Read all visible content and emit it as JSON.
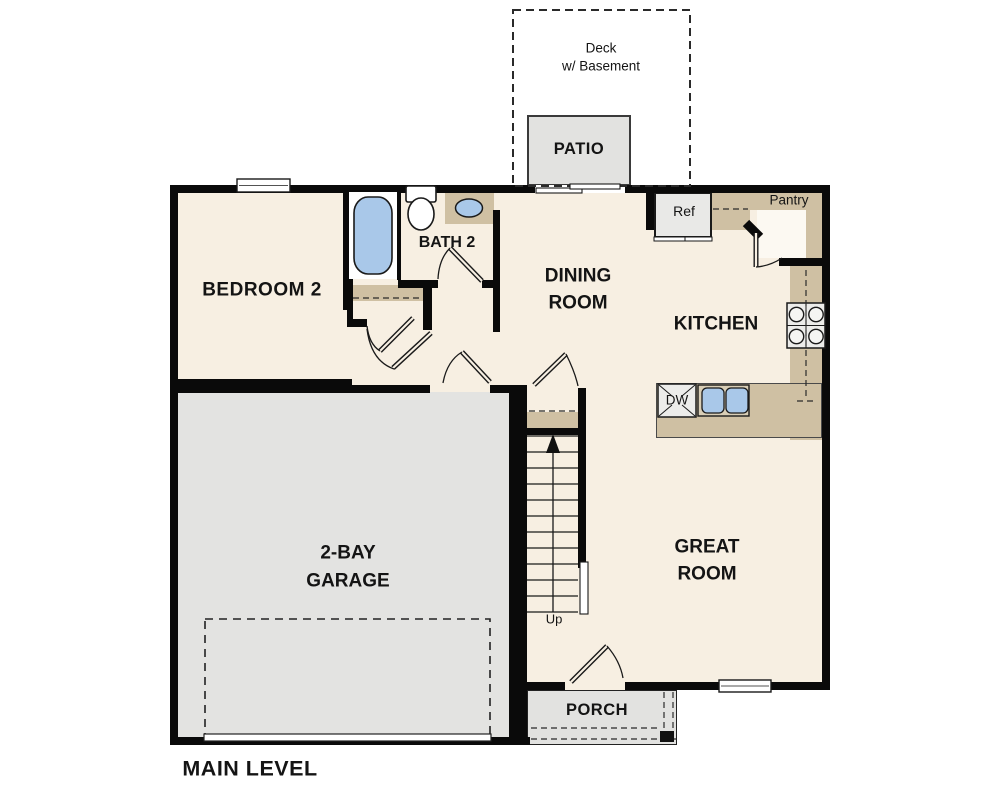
{
  "plan_title": "MAIN LEVEL",
  "rooms": {
    "deck": {
      "line1": "Deck",
      "line2": "w/ Basement"
    },
    "patio": {
      "label": "PATIO"
    },
    "bedroom2": {
      "label": "BEDROOM 2"
    },
    "bath2": {
      "label": "BATH 2"
    },
    "dining_room": {
      "line1": "DINING",
      "line2": "ROOM"
    },
    "kitchen": {
      "label": "KITCHEN"
    },
    "pantry": {
      "label": "Pantry"
    },
    "great_room": {
      "line1": "GREAT",
      "line2": "ROOM"
    },
    "garage": {
      "line1": "2-BAY",
      "line2": "GARAGE"
    },
    "porch": {
      "label": "PORCH"
    }
  },
  "annotations": {
    "refrigerator": "Ref",
    "dishwasher": "DW",
    "stairs": "Up"
  },
  "colors": {
    "floor": "#f7efe2",
    "counter_tan": "#cfc0a3",
    "garage_gray": "#e3e3e1",
    "patio_gray": "#e2e2e0",
    "fixture_blue": "#a9c8e9",
    "wall_black": "#0a0a0a"
  }
}
